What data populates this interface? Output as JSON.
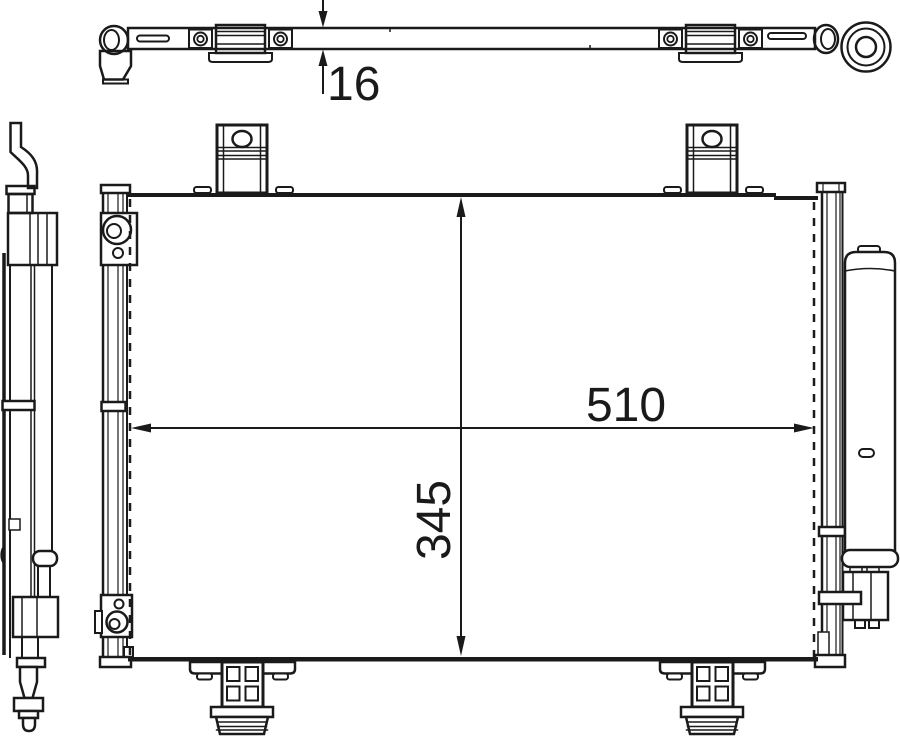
{
  "colors": {
    "background": "#ffffff",
    "line": "#1a1a1a"
  },
  "dimensions": {
    "thickness": "16",
    "width": "510",
    "height": "345"
  }
}
